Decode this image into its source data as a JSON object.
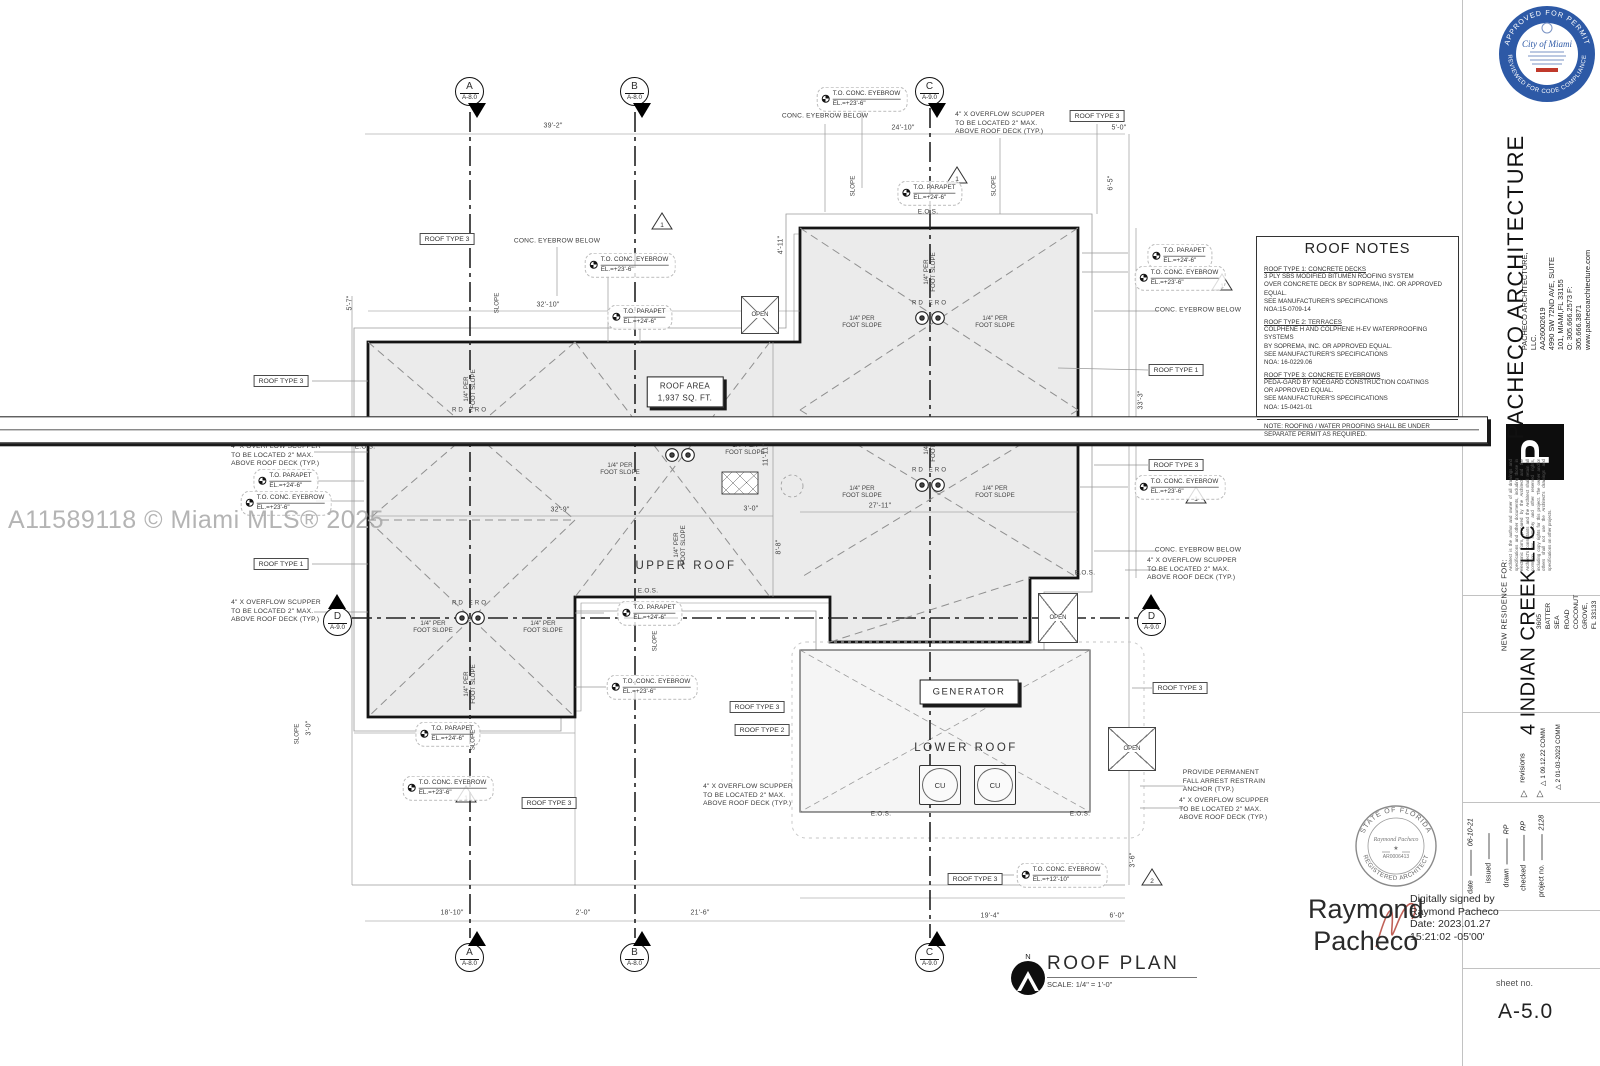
{
  "watermark": {
    "text": "A11589118 © Miami MLS® 2025"
  },
  "city_seal": {
    "top_arc": "APPROVED FOR PERMIT",
    "bottom_arc": "REVIEWED FOR CODE COMPLIANCE",
    "center": "City of Miami"
  },
  "florida_seal": {
    "top_arc": "STATE OF FLORIDA",
    "bottom_arc": "REGISTERED ARCHITECT",
    "name": "Raymond Pacheco",
    "number": "AR0006413",
    "star": "★"
  },
  "signature": {
    "name": "Raymond\nPacheco",
    "details": "Digitally signed by\nRaymond Pacheco\nDate: 2023.01.27\n15:21:02 -05'00'"
  },
  "sheet": {
    "label": "sheet no.",
    "number": "A-5.0"
  },
  "titleblock": {
    "firm_name": "PACHECO ARCHITECTURE",
    "firm_lines": "PACHECO ARCHITECTURE, LLC.\nAA26002619\n4990 SW 72ND AVE, SUITE 101, MIAMI,FL 33155\nO: 305.666.2573  F: 305.666.3871\nwww.pachecoarchitecture.com",
    "logo_letter": "P",
    "disclaimer": "Architect is the author and owner of all drawings and specifications and other documents, including those in electronic form, prepared by the Architect and the Architect's consultants and the Architect shall retain all common law, statutory and other reserved rights, including copy rights for this project. The owner and/or others shall not use the Architect's drawings and specifications on other projects.",
    "project_for": "NEW RESIDENCE FOR:",
    "client": "4 INDIAN CREEK LLC",
    "address": "3605 BATTER SEA ROAD\nCOCONUT GROVE, FL 33133",
    "revisions_label": "revisions",
    "rev1": "1   09.12.22 COMM",
    "rev2": "2   01-03-2023 COMM",
    "fields": {
      "date_label": "date",
      "date_value": "06-10-21",
      "issued_label": "issued",
      "issued_value": "",
      "drawn_label": "drawn",
      "drawn_value": "RP",
      "checked_label": "checked",
      "checked_value": "RP",
      "project_label": "project no.",
      "project_value": "2128"
    }
  },
  "roof_notes": {
    "title": "ROOF NOTES",
    "note1_title": "ROOF TYPE 1: CONCRETE DECKS",
    "note1_body": "3 PLY SBS MODIFIED BITUMEN ROOFING SYSTEM\nOVER CONCRETE DECK BY SOPREMA, INC. OR APPROVED EQUAL.\nSEE MANUFACTURER'S SPECIFICATIONS\nNOA:15-0709-14",
    "note2_title": "ROOF TYPE 2: TERRACES",
    "note2_body": "COLPHENE H AND COLPHENE H-EV WATERPROOFING SYSTEMS\nBY SOPREMA, INC. OR APPROVED EQUAL.\nSEE MANUFACTURER'S SPECIFICATIONS\nNOA: 16-0229.06",
    "note3_title": "ROOF TYPE 3: CONCRETE EYEBROWS",
    "note3_body": "PEDA-GARD BY NOEGARD CONSTRUCTION COATINGS\nOR APPROVED EQUAL.\nSEE MANUFACTURER'S SPECIFICATIONS\nNOA: 15-0421-01",
    "footnote": "NOTE: ROOFING / WATER PROOFING SHALL BE UNDER\nSEPARATE PERMIT AS REQUIRED."
  },
  "plan_title": {
    "title": "ROOF PLAN",
    "scale": "SCALE: 1/4\" = 1'-0\"",
    "north": "N"
  },
  "grid": {
    "a": "A",
    "b": "B",
    "c": "C",
    "d": "D",
    "ref_a": "A-8.0",
    "ref_c": "A-9.0"
  },
  "labels": {
    "roof_type_1": "ROOF TYPE 1",
    "roof_type_2": "ROOF TYPE 2",
    "roof_type_3": "ROOF TYPE 3",
    "to_parapet": "T.O. PARAPET",
    "el_24_6": "EL.=+24'-6\"",
    "to_conc_eyebrow": "T.O. CONC. EYEBROW",
    "el_23_6": "EL.=+23'-6\"",
    "el_12_10": "EL.=+12'-10\"",
    "conc_eyebrow_below": "CONC. EYEBROW BELOW",
    "scupper": "4\" X OVERFLOW SCUPPER\nTO BE LOCATED 2\" MAX.\nABOVE ROOF DECK (TYP.)",
    "fall_arrest": "PROVIDE PERMANENT\nFALL ARREST RESTRAIN\nANCHOR (TYP.)",
    "slope_quarter": "1/4\" PER\nFOOT SLOPE",
    "slope": "SLOPE",
    "eos": "E.O.S.",
    "rd_ero": "RD  ERO",
    "upper_roof": "UPPER ROOF",
    "lower_roof": "LOWER ROOF",
    "generator": "GENERATOR",
    "cu": "CU",
    "open": "OPEN",
    "roof_area": "ROOF AREA\n1,937 SQ. FT.",
    "to_roof_slab": "T.O. ROOF SLAB",
    "slab_elev": "ELEV. = +23'-6\"",
    "rev_1": "1",
    "rev_2": "2"
  },
  "dims": {
    "d1": "39'-2\"",
    "d2": "24'-10\"",
    "d3": "5'-0\"",
    "d4": "32'-10\"",
    "d5": "32'-9\"",
    "d6": "27'-11\"",
    "d7": "11'-11\"",
    "d8": "33'-3\"",
    "d9": "18'-10\"",
    "d10": "21'-6\"",
    "d11": "19'-4\"",
    "d12": "6'-0\"",
    "d13": "3'-6\"",
    "d14": "5'-7\"",
    "d15": "3'-0\"",
    "d16": "4'-11\"",
    "d17": "6'-5\"",
    "d18": "8'-8\"",
    "d19": "2'-0\"",
    "d20": "3'-0\""
  }
}
